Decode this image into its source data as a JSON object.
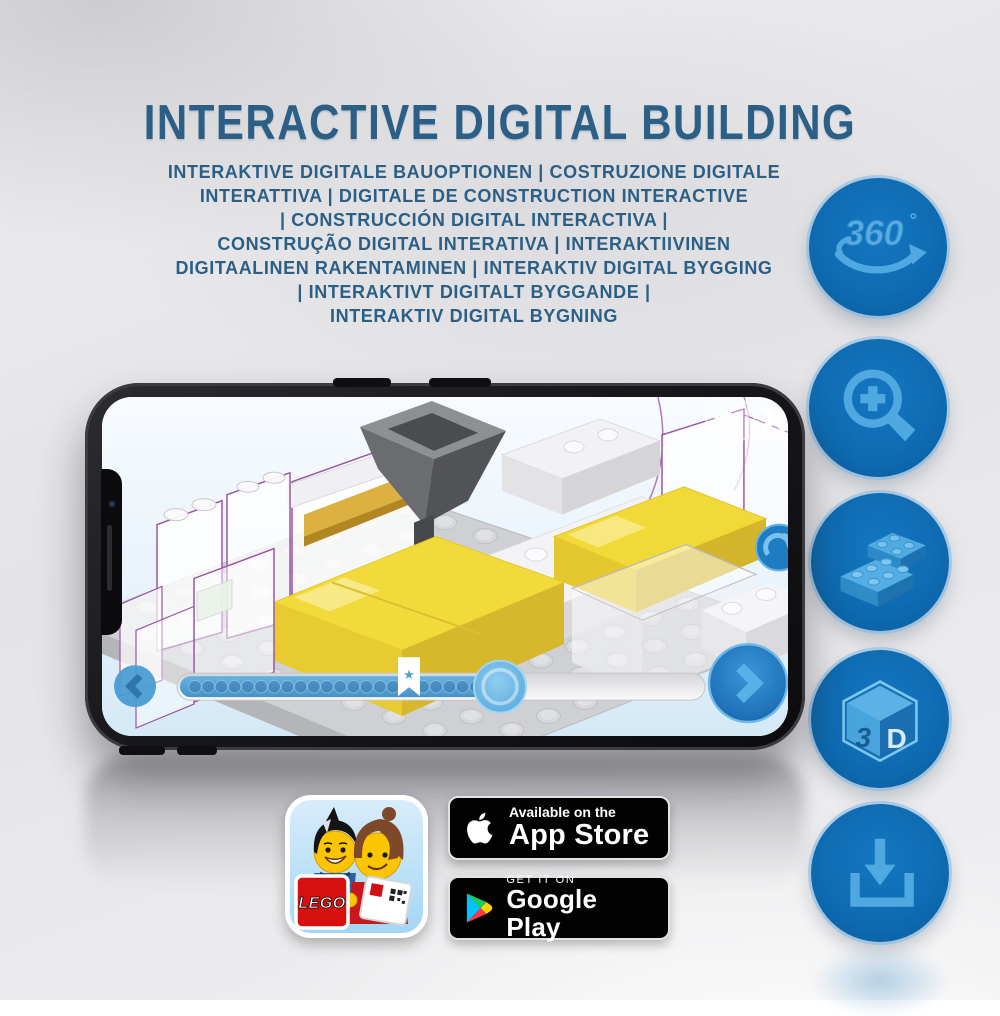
{
  "title": "INTERACTIVE DIGITAL BUILDING",
  "subtitle_lines": [
    "INTERAKTIVE DIGITALE BAUOPTIONEN | COSTRUZIONE DIGITALE",
    "INTERATTIVA | DIGITALE DE CONSTRUCTION INTERACTIVE",
    "| CONSTRUCCIÓN DIGITAL INTERACTIVA |",
    "CONSTRUÇÃO DIGITAL INTERATIVA | INTERAKTIIVINEN",
    "DIGITAALINEN RAKENTAMINEN | INTERAKTIV DIGITAL BYGGING",
    "| INTERAKTIVT DIGITALT BYGGANDE |",
    "INTERAKTIV DIGITAL BYGNING"
  ],
  "feature_icons": {
    "rotation_label": "360",
    "rotation_degree": "°",
    "cube_left": "3",
    "cube_right": "D"
  },
  "phone": {
    "slider": {
      "dots_before_bookmark": 16,
      "dots_after_bookmark": 6,
      "bookmark_star": "★",
      "progress_percent": 62
    }
  },
  "store": {
    "lego_logo": "LEGO",
    "app_store": {
      "tagline": "Available on the",
      "name": "App Store"
    },
    "google_play": {
      "tagline": "GET IT ON",
      "name": "Google Play"
    }
  },
  "colors": {
    "title_blue": "#2b5f86",
    "icon_circle_blue": "#0f6cb2",
    "icon_glyph_blue": "#4fa8e0",
    "brick_yellow": "#f2da3a",
    "slider_fill_blue": "#5ba8da"
  }
}
